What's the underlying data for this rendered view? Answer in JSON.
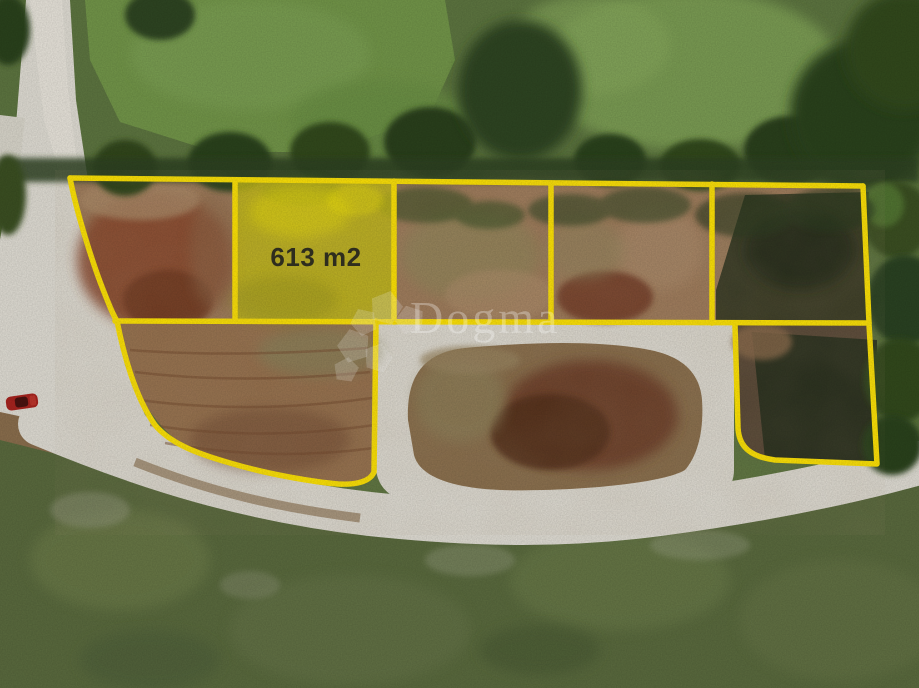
{
  "scene": {
    "kind": "aerial-drone-photo-of-land-parcels",
    "highlighted_parcel": {
      "area_label": "613 m2"
    },
    "watermark": {
      "text": "Dogma",
      "logo": "dogma-flower-logo"
    },
    "objects": {
      "car": "red-car",
      "road": "white-gravel-road",
      "parcels_outlined": 7
    },
    "colors": {
      "boundary_yellow": "#FFE402",
      "parcel_highlight_fill": "#F0E000",
      "area_label_text": "#2E2D1E",
      "watermark_white": "rgba(255,255,255,0.30)",
      "road_gravel": "#DFDCD3",
      "cleared_dirt": "#9F7C5C",
      "red_dirt": "#8A4A2F",
      "meadow_green": "#729549",
      "tree_dark_green": "#2F4322",
      "scrub_green": "#5A6A3E",
      "car_red": "#A8241F"
    }
  }
}
